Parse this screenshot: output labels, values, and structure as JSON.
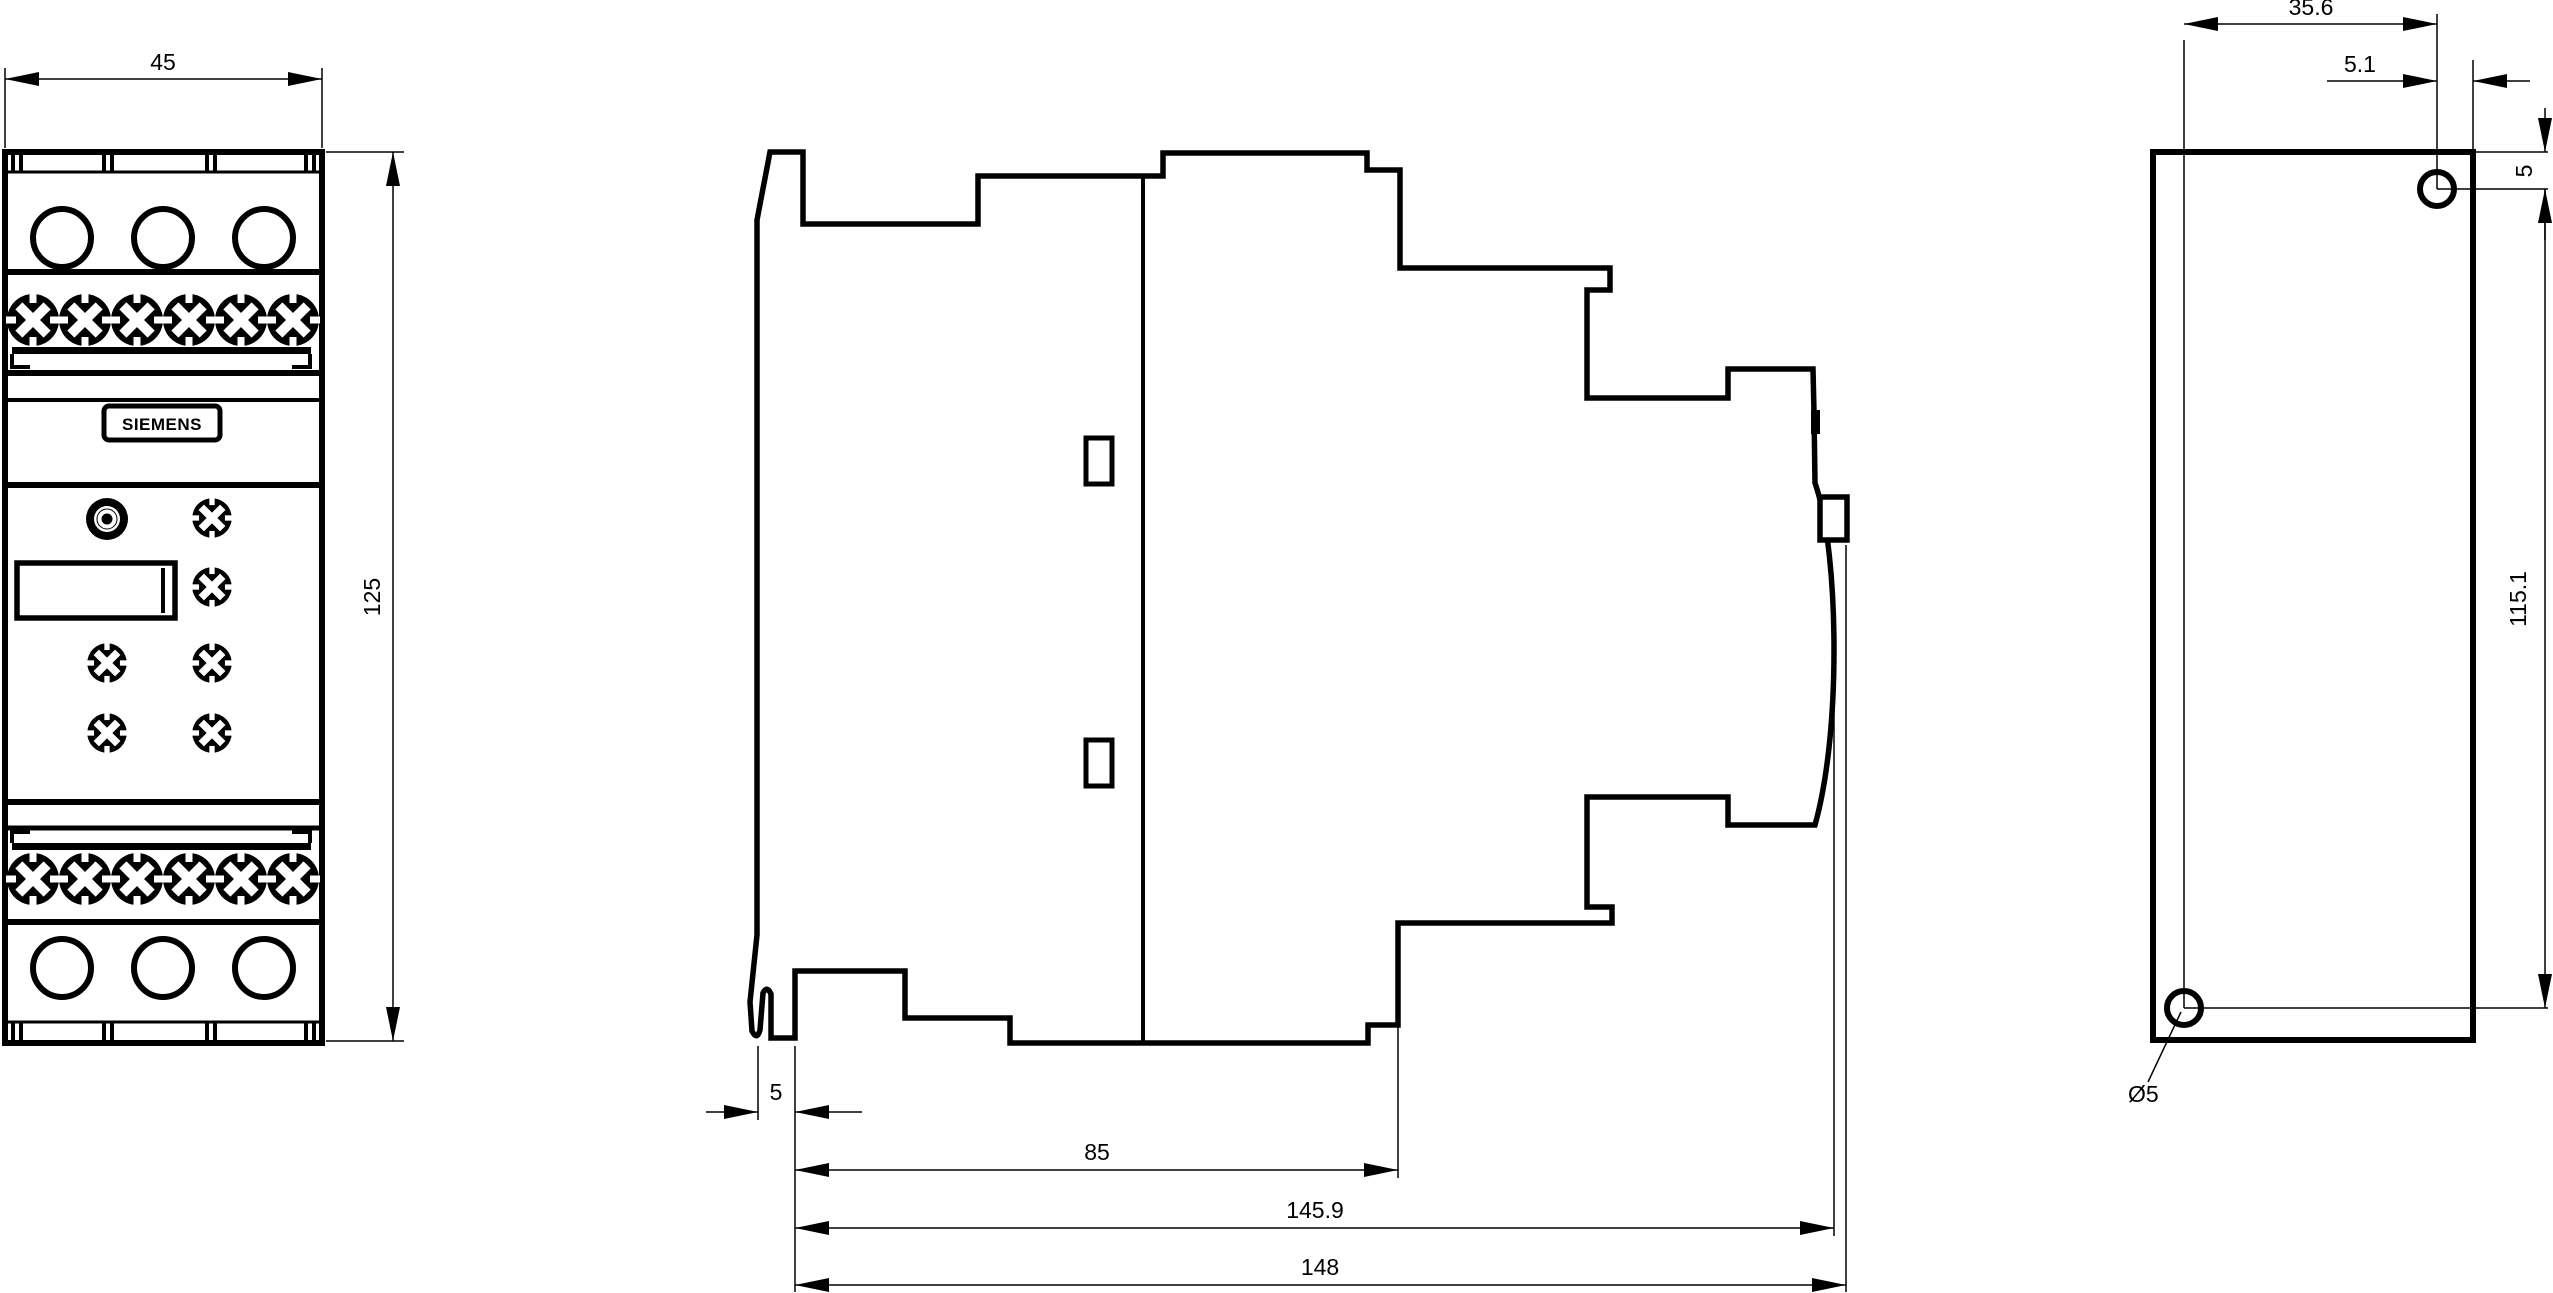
{
  "drawing": {
    "title": "device-dimension-drawing",
    "brand_label": "SIEMENS",
    "colors": {
      "line": "#000000",
      "background": "#ffffff"
    },
    "views": {
      "front": {
        "label": "front-view",
        "width_dim": "45",
        "height_dim": "125"
      },
      "side": {
        "label": "side-view",
        "plate_thickness_dim": "5",
        "body_depth_dim": "85",
        "depth_to_bulge_dim": "145.9",
        "total_depth_dim": "148"
      },
      "rear": {
        "label": "rear-panel-view",
        "hole_offset_x_dim": "35.6",
        "hole_to_edge_dim": "5.1",
        "hole_to_top_dim": "5",
        "hole_spacing_dim": "115.1",
        "hole_diameter_dim": "Ø5"
      }
    }
  }
}
